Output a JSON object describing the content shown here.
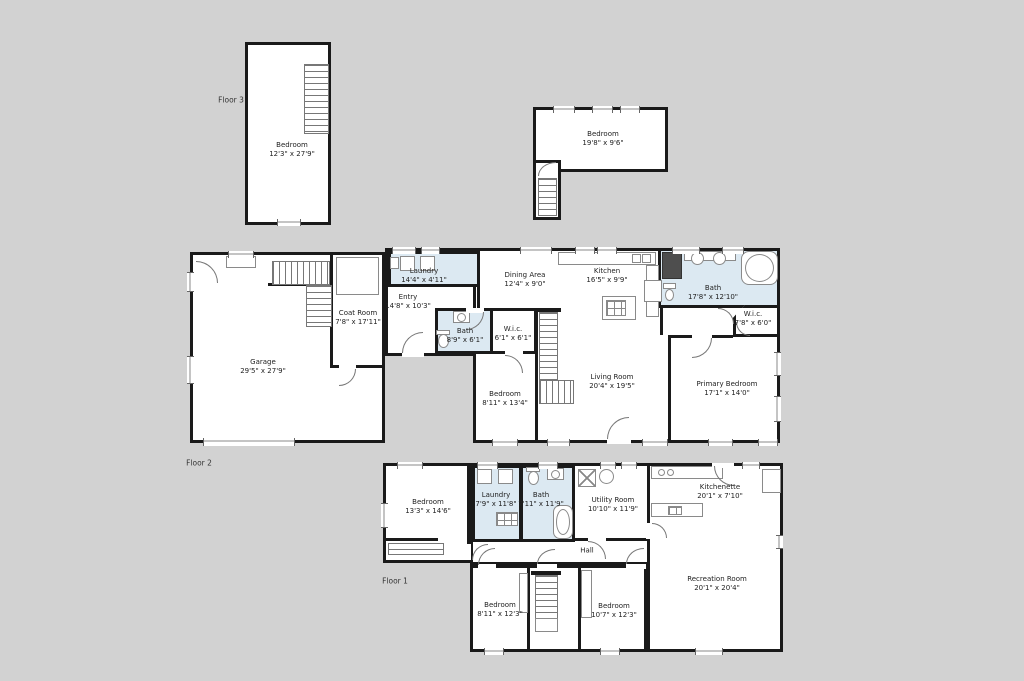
{
  "colors": {
    "background": "#d2d2d2",
    "wall": "#1a1a1a",
    "room_fill": "#ffffff",
    "wet_room_fill": "#dce9f2"
  },
  "floor_labels": {
    "floor1": "Floor 1",
    "floor2": "Floor 2",
    "floor3": "Floor 3"
  },
  "rooms": {
    "f3_bedroom": {
      "name": "Bedroom",
      "dims": "12'3\" x 27'9\""
    },
    "f3_bedroom2": {
      "name": "Bedroom",
      "dims": "19'8\" x 9'6\""
    },
    "f2_garage": {
      "name": "Garage",
      "dims": "29'5\" x 27'9\""
    },
    "f2_coat_room": {
      "name": "Coat Room",
      "dims": "7'8\" x 17'11\""
    },
    "f2_laundry": {
      "name": "Laundry",
      "dims": "14'4\" x 4'11\""
    },
    "f2_entry": {
      "name": "Entry",
      "dims": "14'8\" x 10'3\""
    },
    "f2_dining": {
      "name": "Dining Area",
      "dims": "12'4\" x 9'0\""
    },
    "f2_kitchen": {
      "name": "Kitchen",
      "dims": "16'5\" x 9'9\""
    },
    "f2_bath_small": {
      "name": "Bath",
      "dims": "8'9\" x 6'1\""
    },
    "f2_wic_small": {
      "name": "W.i.c.",
      "dims": "6'1\" x 6'1\""
    },
    "f2_bath": {
      "name": "Bath",
      "dims": "17'8\" x 12'10\""
    },
    "f2_wic": {
      "name": "W.i.c.",
      "dims": "7'8\" x 6'0\""
    },
    "f2_bedroom": {
      "name": "Bedroom",
      "dims": "8'11\" x 13'4\""
    },
    "f2_living": {
      "name": "Living Room",
      "dims": "20'4\" x 19'5\""
    },
    "f2_primary": {
      "name": "Primary Bedroom",
      "dims": "17'1\" x 14'0\""
    },
    "f1_bedroom": {
      "name": "Bedroom",
      "dims": "13'3\" x 14'6\""
    },
    "f1_laundry": {
      "name": "Laundry",
      "dims": "7'9\" x 11'8\""
    },
    "f1_bath": {
      "name": "Bath",
      "dims": "7'11\" x 11'9\""
    },
    "f1_utility": {
      "name": "Utility Room",
      "dims": "10'10\" x 11'9\""
    },
    "f1_hall": {
      "name": "Hall"
    },
    "f1_kitchenette": {
      "name": "Kitchenette",
      "dims": "20'1\" x 7'10\""
    },
    "f1_rec": {
      "name": "Recreation Room",
      "dims": "20'1\" x 20'4\""
    },
    "f1_bedroom_bl": {
      "name": "Bedroom",
      "dims": "8'11\" x 12'3\""
    },
    "f1_bedroom_br": {
      "name": "Bedroom",
      "dims": "10'7\" x 12'3\""
    }
  }
}
